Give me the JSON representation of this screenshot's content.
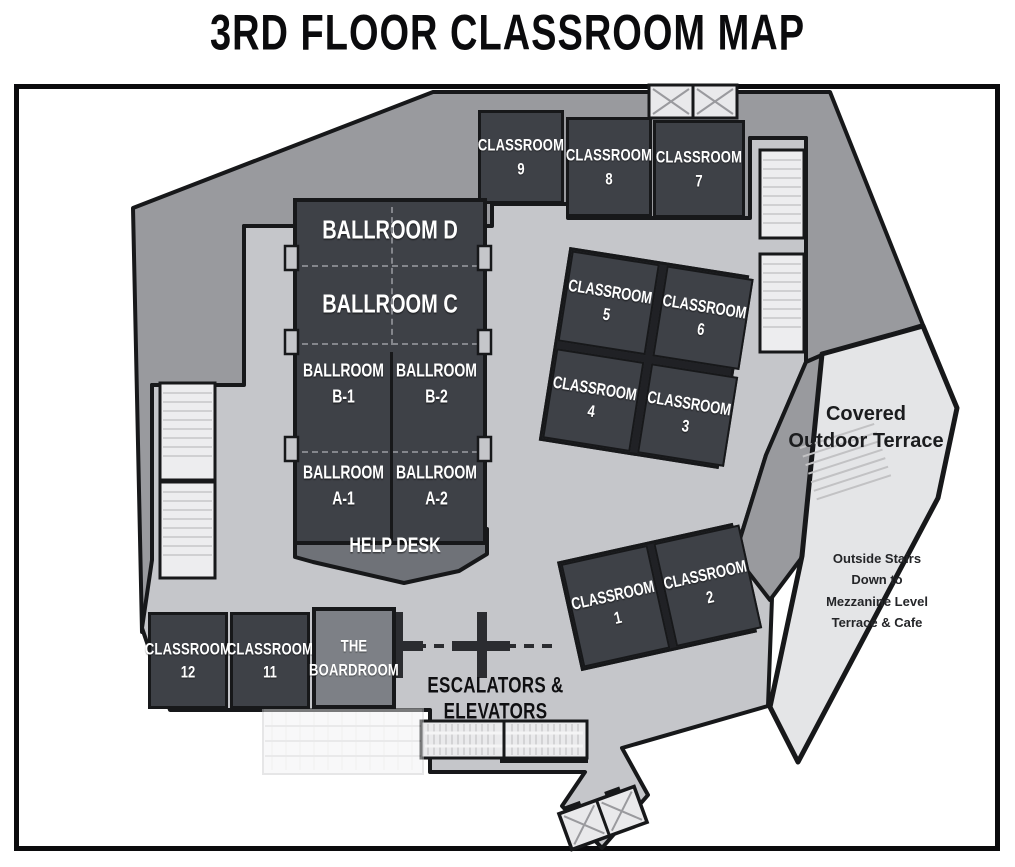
{
  "title": "3rd Floor Classroom Map",
  "rooms": {
    "classroom_9": {
      "line1": "Classroom",
      "line2": "9"
    },
    "classroom_8": {
      "line1": "Classroom",
      "line2": "8"
    },
    "classroom_7": {
      "line1": "Classroom",
      "line2": "7"
    },
    "classroom_5": {
      "line1": "Classroom",
      "line2": "5"
    },
    "classroom_6": {
      "line1": "Classroom",
      "line2": "6"
    },
    "classroom_4": {
      "line1": "Classroom",
      "line2": "4"
    },
    "classroom_3": {
      "line1": "Classroom",
      "line2": "3"
    },
    "classroom_1": {
      "line1": "Classroom",
      "line2": "1"
    },
    "classroom_2": {
      "line1": "Classroom",
      "line2": "2"
    },
    "classroom_12": {
      "line1": "Classroom",
      "line2": "12"
    },
    "classroom_11": {
      "line1": "Classroom",
      "line2": "11"
    },
    "boardroom": {
      "line1": "The",
      "line2": "Boardroom"
    },
    "ballroom_d": {
      "label": "Ballroom D"
    },
    "ballroom_c": {
      "label": "Ballroom C"
    },
    "ballroom_b1": {
      "line1": "Ballroom",
      "line2": "B-1"
    },
    "ballroom_b2": {
      "line1": "Ballroom",
      "line2": "B-2"
    },
    "ballroom_a1": {
      "line1": "Ballroom",
      "line2": "A-1"
    },
    "ballroom_a2": {
      "line1": "Ballroom",
      "line2": "A-2"
    }
  },
  "areas": {
    "help_desk": "Help Desk",
    "escalators": "Escalators & Elevators",
    "terrace": {
      "line1": "Covered",
      "line2": "Outdoor Terrace"
    },
    "outside_stairs": {
      "line1": "Outside Stairs",
      "line2": "Down to",
      "line3": "Mezzanine Level",
      "line4": "Terrace & Cafe"
    }
  },
  "colors": {
    "room_dark": "#3e4147",
    "wall": "#17181a",
    "back_of_house": "#999a9e",
    "concourse": "#c5c6ca",
    "terrace": "#e4e5e7",
    "stairwell": "#ededef",
    "boardroom_fill": "#7d8086",
    "help_desk_fill": "#6f7278"
  }
}
